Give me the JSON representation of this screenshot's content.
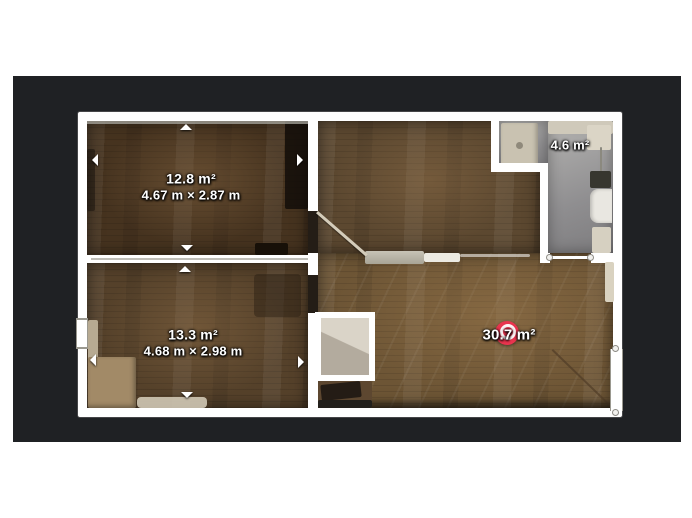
{
  "app": {
    "page_background": "#ffffff",
    "canvas_background": "#1f2124",
    "wall_color": "#ffffff"
  },
  "floorplan": {
    "rooms": [
      {
        "id": "room-top-left",
        "area_label": "12.8 m²",
        "dimensions_label": "4.67 m × 2.87 m"
      },
      {
        "id": "room-bottom-left",
        "area_label": "13.3 m²",
        "dimensions_label": "4.68 m × 2.98 m"
      },
      {
        "id": "bathroom",
        "area_label": "4.6 m²"
      },
      {
        "id": "living-room",
        "area_label": "30.7 m²"
      }
    ],
    "marker": {
      "id": "camera-360-marker",
      "color": "#e8344e"
    }
  }
}
